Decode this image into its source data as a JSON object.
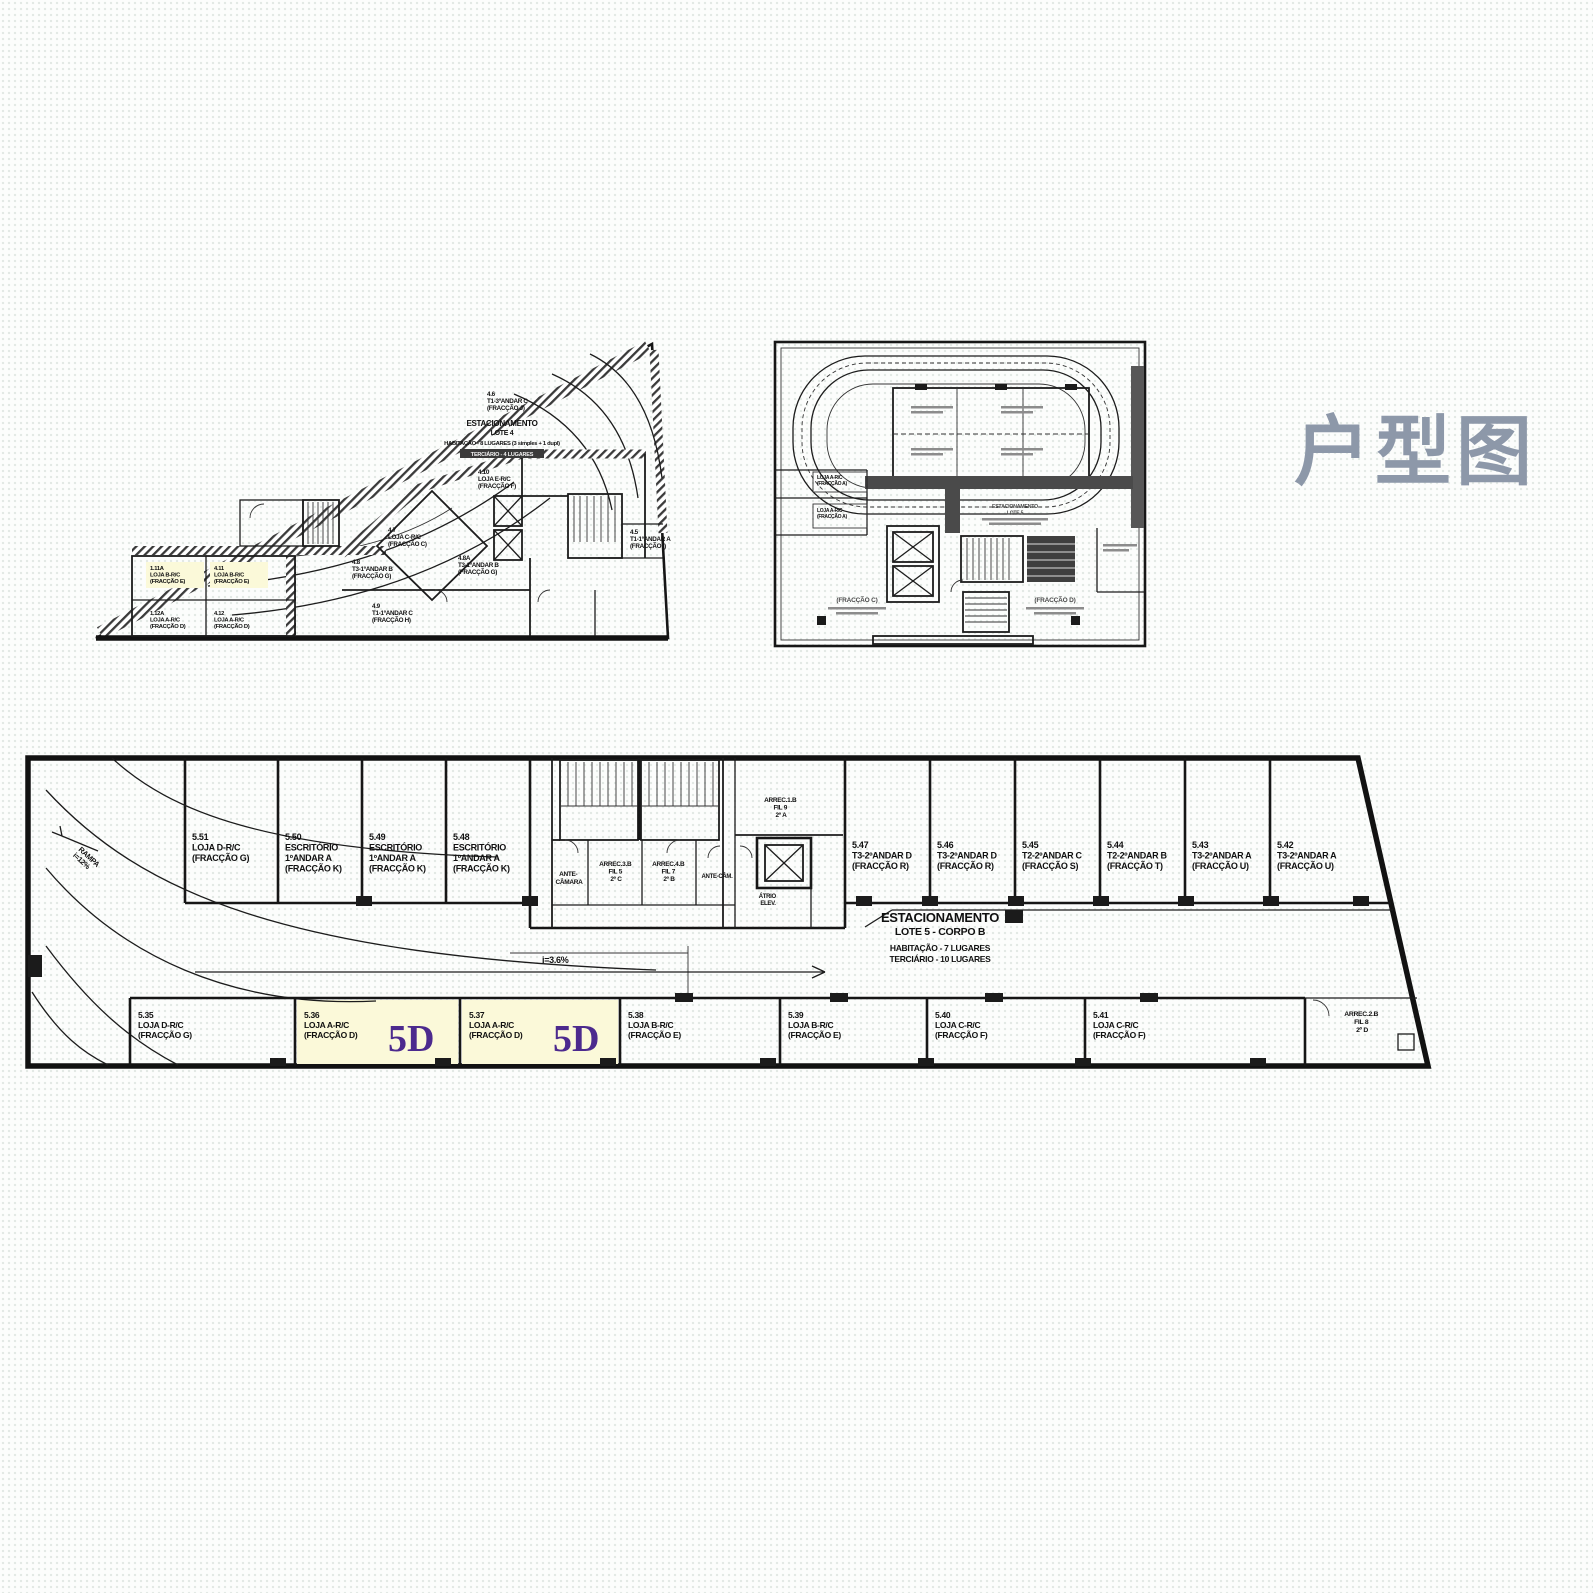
{
  "page": {
    "title_cn": "户型图"
  },
  "colors": {
    "title": "#8d98a9",
    "accent_5d": "#4c2a8e",
    "highlight": "#fbf9d9",
    "line": "#1c1c1c"
  },
  "plan_lote4": {
    "note": {
      "l1": "ESTACIONAMENTO",
      "l2": "LOTE 4",
      "l3": "HABITAÇÃO - 8 LUGARES (3 simples + 1 dupl)",
      "l4": "TERCIÁRIO - 4 LUGARES"
    },
    "units": [
      {
        "id": "4.6",
        "use": "T1-3ºANDAR C",
        "fraction": "(FRACÇÃO J)"
      },
      {
        "id": "4.10",
        "use": "LOJA E-R/C",
        "fraction": "(FRACÇÃO F)"
      },
      {
        "id": "4.7",
        "use": "LOJA C-R/C",
        "fraction": "(FRACÇÃO C)"
      },
      {
        "id": "4.5",
        "use": "T1-1ºANDAR A",
        "fraction": "(FRACÇÃO I)"
      },
      {
        "id": "4.8",
        "use": "T3-1ºANDAR B",
        "fraction": "(FRACÇÃO G)"
      },
      {
        "id": "4.8A",
        "use": "T3-1ºANDAR B",
        "fraction": "(FRACÇÃO G)"
      },
      {
        "id": "4.9",
        "use": "T1-1ºANDAR C",
        "fraction": "(FRACÇÃO H)"
      },
      {
        "id": "1.11A",
        "use": "LOJA B-R/C",
        "fraction": "(FRACÇÃO E)"
      },
      {
        "id": "4.11",
        "use": "LOJA B-R/C",
        "fraction": "(FRACÇÃO E)"
      },
      {
        "id": "1.12A",
        "use": "LOJA A-R/C",
        "fraction": "(FRACÇÃO D)"
      },
      {
        "id": "4.12",
        "use": "LOJA A-R/C",
        "fraction": "(FRACÇÃO D)"
      }
    ]
  },
  "plan_lote5": {
    "note": {
      "l1": "ESTACIONAMENTO",
      "l2": "LOTE 5"
    },
    "shops": [
      {
        "l1": "LOJA A-R/C",
        "l2": "(FRACÇÃO A)"
      },
      {
        "l1": "LOJA A-R/C",
        "l2": "(FRACÇÃO A)"
      }
    ],
    "frac_left": "(FRACÇÃO C)",
    "frac_right": "(FRACÇÃO D)"
  },
  "plan_corpo_b": {
    "note": {
      "l1": "ESTACIONAMENTO",
      "l2": "LOTE 5 - CORPO B",
      "l3": "HABITAÇÃO - 7 LUGARES",
      "l4": "TERCIÁRIO - 10 LUGARES"
    },
    "slope_label": "i=3.6%",
    "ramp": {
      "l1": "RAMPA",
      "l2": "i=12%"
    },
    "upper_units": [
      {
        "id": "5.51",
        "l1": "LOJA D-R/C",
        "l2": "(FRACÇÃO G)"
      },
      {
        "id": "5.50",
        "l1": "ESCRITÓRIO",
        "l2": "1ºANDAR A",
        "l3": "(FRACÇÃO K)"
      },
      {
        "id": "5.49",
        "l1": "ESCRITÓRIO",
        "l2": "1ºANDAR A",
        "l3": "(FRACÇÃO K)"
      },
      {
        "id": "5.48",
        "l1": "ESCRITÓRIO",
        "l2": "1ºANDAR A",
        "l3": "(FRACÇÃO K)"
      },
      {
        "id": "5.47",
        "l1": "T3-2ºANDAR D",
        "l2": "(FRACÇÃO R)"
      },
      {
        "id": "5.46",
        "l1": "T3-2ºANDAR D",
        "l2": "(FRACÇÃO R)"
      },
      {
        "id": "5.45",
        "l1": "T2-2ºANDAR C",
        "l2": "(FRACÇÃO S)"
      },
      {
        "id": "5.44",
        "l1": "T2-2ºANDAR B",
        "l2": "(FRACÇÃO T)"
      },
      {
        "id": "5.43",
        "l1": "T3-2ºANDAR A",
        "l2": "(FRACÇÃO U)"
      },
      {
        "id": "5.42",
        "l1": "T3-2ºANDAR A",
        "l2": "(FRACÇÃO U)"
      }
    ],
    "lower_units": [
      {
        "id": "5.35",
        "l1": "LOJA D-R/C",
        "l2": "(FRACÇÃO G)",
        "tag": ""
      },
      {
        "id": "5.36",
        "l1": "LOJA A-R/C",
        "l2": "(FRACÇÃO D)",
        "tag": "5D"
      },
      {
        "id": "5.37",
        "l1": "LOJA A-R/C",
        "l2": "(FRACÇÃO D)",
        "tag": "5D"
      },
      {
        "id": "5.38",
        "l1": "LOJA B-R/C",
        "l2": "(FRACÇÃO E)",
        "tag": ""
      },
      {
        "id": "5.39",
        "l1": "LOJA B-R/C",
        "l2": "(FRACÇÃO E)",
        "tag": ""
      },
      {
        "id": "5.40",
        "l1": "LOJA C-R/C",
        "l2": "(FRACÇÃO F)",
        "tag": ""
      },
      {
        "id": "5.41",
        "l1": "LOJA C-R/C",
        "l2": "(FRACÇÃO F)",
        "tag": ""
      }
    ],
    "core": [
      {
        "l1": "ANTE-",
        "l2": "CÂMARA"
      },
      {
        "l1": "ARREC.3.B",
        "l2": "FIL 5",
        "l3": "2º C"
      },
      {
        "l1": "ARREC.4.B",
        "l2": "FIL 7",
        "l3": "2º B"
      },
      {
        "l1": "ANTE-CÂM."
      },
      {
        "l1": "ÁTRIO",
        "l2": "ELEV."
      },
      {
        "l1": "ARREC.1.B",
        "l2": "FIL 9",
        "l3": "2º A"
      }
    ],
    "arrec2": {
      "l1": "ARREC.2.B",
      "l2": "FIL 8",
      "l3": "2º D"
    }
  }
}
